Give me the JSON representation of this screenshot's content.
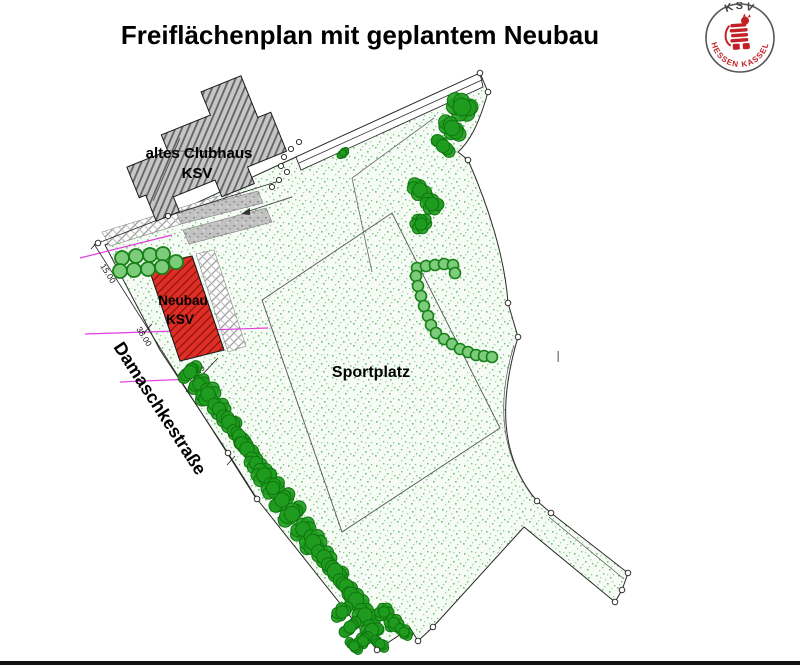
{
  "title": "Freiflächenplan mit geplantem Neubau",
  "logo": {
    "club": "KSV",
    "region": "HESSEN  KASSEL"
  },
  "plan": {
    "labels": {
      "clubhouse_line1": "altes Clubhaus",
      "clubhouse_line2": "KSV",
      "neubau_line1": "Neubau",
      "neubau_line2": "KSV",
      "sportplatz": "Sportplatz",
      "street": "Damaschkestraße"
    },
    "dimensions": {
      "street_upper": "15.00",
      "street_lower": "38.00",
      "building": "16.49"
    },
    "artifacts": {
      "cursor": "I"
    },
    "colors": {
      "neubau_red": "#dd2f27",
      "neubau_hatch": "#9b140c",
      "tree_green": "#1f9c1f",
      "tree_dark": "#0e760e",
      "bush_green": "#7ccc7c",
      "bush_stroke": "#178017",
      "stipple_green": "#6ec46e",
      "clubhouse_gray": "#c6c6c6",
      "magenta": "#e23ce2",
      "outline": "#1a1a1a"
    }
  }
}
